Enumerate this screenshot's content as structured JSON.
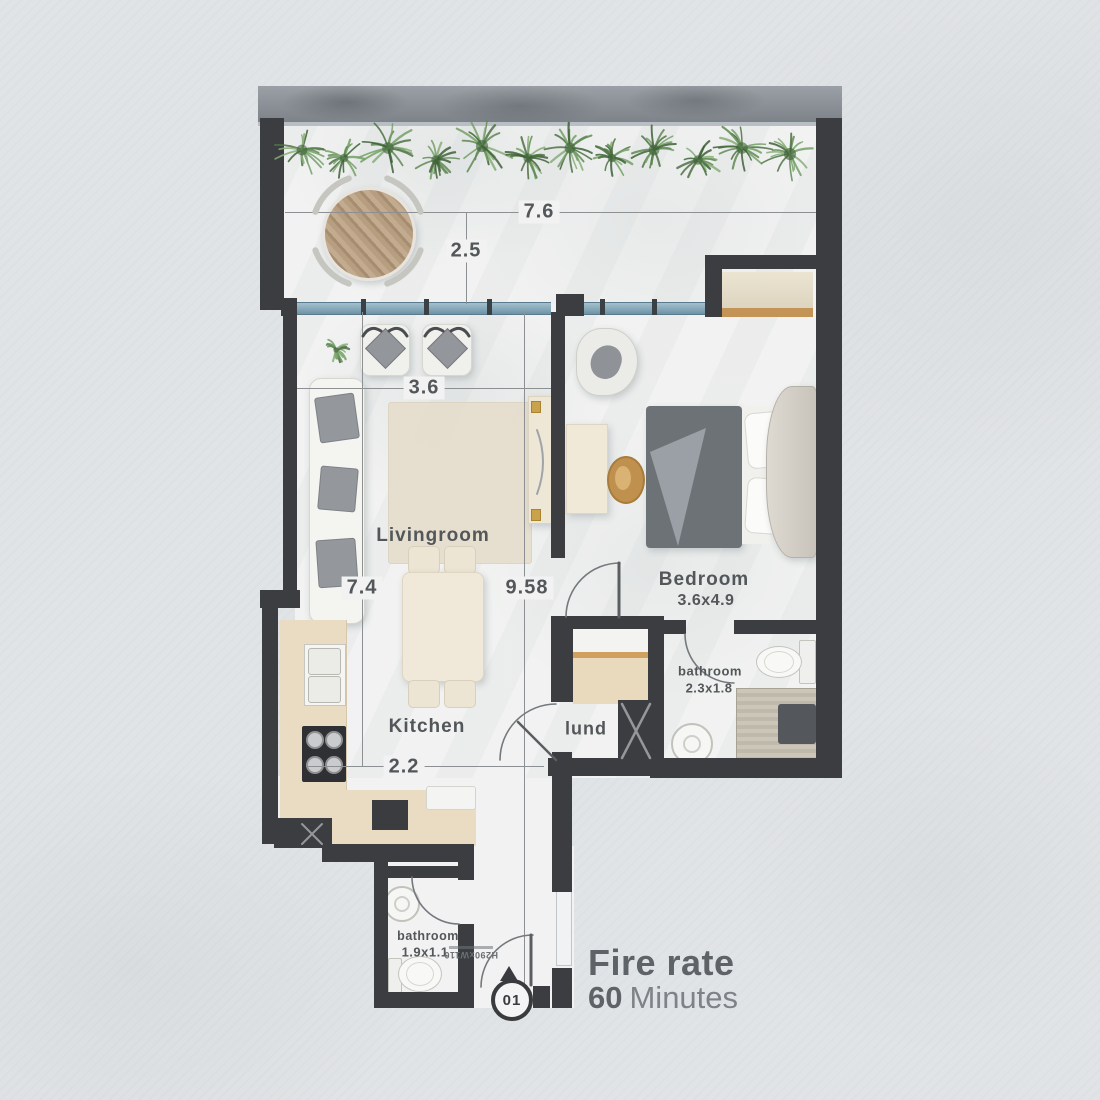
{
  "plan": {
    "rooms": {
      "livingroom": {
        "label": "Livingroom"
      },
      "kitchen": {
        "label": "Kitchen"
      },
      "bedroom": {
        "label": "Bedroom",
        "size": "3.6x4.9"
      },
      "bathroom_ensuite": {
        "label": "bathroom",
        "size": "2.3x1.8"
      },
      "laundry": {
        "label": "lund"
      },
      "bathroom_entry": {
        "label": "bathroom",
        "size": "1.9x1.1"
      }
    },
    "dimensions": {
      "balcony_width": "7.6",
      "balcony_depth": "2.5",
      "living_width": "3.6",
      "living_depth": "7.4",
      "unit_depth": "9.58",
      "kitchen_width": "2.2"
    },
    "entrance": {
      "unit_number": "01",
      "door_spec": "H290xW110"
    },
    "fire_rating": {
      "title": "Fire rate",
      "value": "60",
      "unit": "Minutes"
    },
    "colors": {
      "wall": "#3b3d40",
      "glass": "#7e9fb2",
      "floor": "#f1f2f1",
      "accent_wood": "#c89a62",
      "text": "#53575a"
    }
  }
}
